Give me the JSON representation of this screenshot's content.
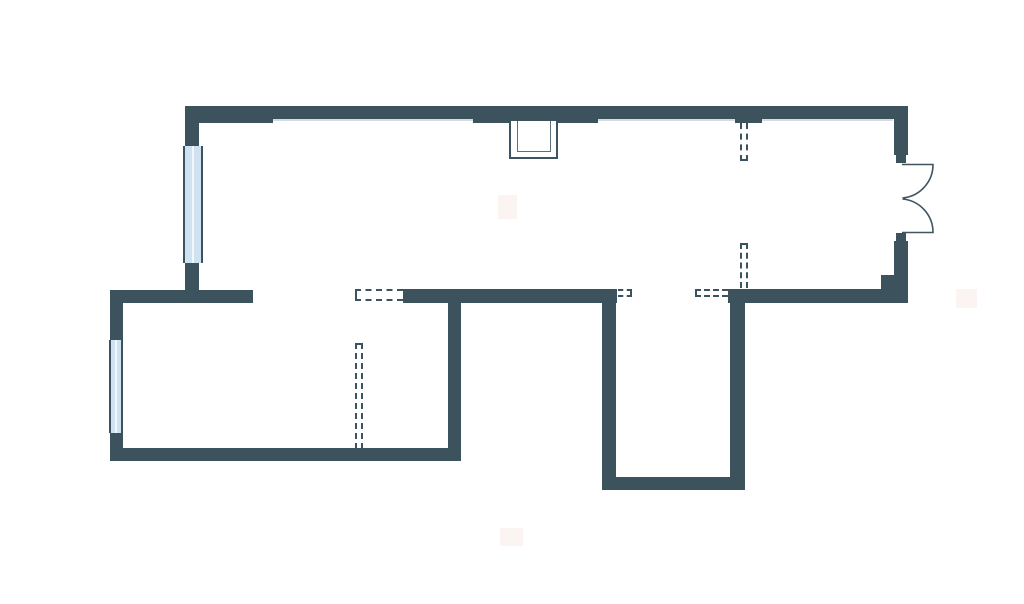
{
  "page": {
    "title": "apartment-floor-plan",
    "description": "2D architectural floor plan with solid walls, two glazed windows, a double-swing entrance door, a ventilation shaft and dashed demolished/optional partition markers. No visible text labels."
  },
  "canvas": {
    "width": 1024,
    "height": 604,
    "background": "#ffffff"
  },
  "colors": {
    "wall": "#3C525C",
    "sill_line": "#D5DDE1",
    "window_glass": "#CFE2F2",
    "window_divider": "#F2F7FB",
    "window_frame": "#3C525C",
    "shaft_outer": "#3E545E",
    "shaft_inner": "#5E707A",
    "door": "#3F555F",
    "dashed": "#3C525C",
    "artifact": "#F9EDE9"
  },
  "plan": {
    "walls": [
      {
        "name": "top-wall-main",
        "x": 185,
        "y": 106,
        "w": 723,
        "h": 13
      },
      {
        "name": "top-wall-thick-left",
        "x": 185,
        "y": 106,
        "w": 88,
        "h": 17
      },
      {
        "name": "top-wall-thick-center",
        "x": 473,
        "y": 106,
        "w": 125,
        "h": 17
      },
      {
        "name": "top-wall-thick-right",
        "x": 735,
        "y": 106,
        "w": 27,
        "h": 17
      },
      {
        "name": "left-upper-wall-above-window",
        "x": 185,
        "y": 106,
        "w": 14,
        "h": 42
      },
      {
        "name": "left-upper-wall-below-window",
        "x": 185,
        "y": 261,
        "w": 14,
        "h": 42
      },
      {
        "name": "middle-wall-left",
        "x": 110,
        "y": 290,
        "w": 143,
        "h": 13
      },
      {
        "name": "middle-wall-center",
        "x": 403,
        "y": 289,
        "w": 214,
        "h": 14
      },
      {
        "name": "middle-wall-right",
        "x": 728,
        "y": 289,
        "w": 180,
        "h": 14
      },
      {
        "name": "left-lower-wall-above-window",
        "x": 110,
        "y": 290,
        "w": 13,
        "h": 51
      },
      {
        "name": "left-lower-wall-below-window",
        "x": 110,
        "y": 432,
        "w": 13,
        "h": 29
      },
      {
        "name": "bottom-wall-lower-room",
        "x": 110,
        "y": 448,
        "w": 351,
        "h": 13
      },
      {
        "name": "lower-room-right-wall",
        "x": 448,
        "y": 302,
        "w": 13,
        "h": 159
      },
      {
        "name": "protrusion-left-wall",
        "x": 602,
        "y": 302,
        "w": 14,
        "h": 178
      },
      {
        "name": "protrusion-bottom-wall",
        "x": 602,
        "y": 477,
        "w": 143,
        "h": 13
      },
      {
        "name": "protrusion-right-wall",
        "x": 730,
        "y": 303,
        "w": 15,
        "h": 187
      },
      {
        "name": "right-wall-above-door",
        "x": 894,
        "y": 106,
        "w": 14,
        "h": 49
      },
      {
        "name": "right-wall-below-door",
        "x": 894,
        "y": 241,
        "w": 14,
        "h": 62
      },
      {
        "name": "right-wall-pier",
        "x": 881,
        "y": 275,
        "w": 27,
        "h": 28
      },
      {
        "name": "door-jamb-top",
        "x": 896,
        "y": 155,
        "w": 10,
        "h": 8
      },
      {
        "name": "door-jamb-bottom",
        "x": 896,
        "y": 233,
        "w": 10,
        "h": 8
      }
    ],
    "sill_lines": [
      {
        "name": "top-wall-sill-line-a",
        "x": 273,
        "y": 119,
        "w": 200,
        "h": 2
      },
      {
        "name": "top-wall-sill-line-b",
        "x": 598,
        "y": 119,
        "w": 137,
        "h": 2
      },
      {
        "name": "top-wall-sill-line-c",
        "x": 762,
        "y": 119,
        "w": 131,
        "h": 2
      }
    ],
    "windows": [
      {
        "name": "window-upper-left",
        "x": 183,
        "y": 146,
        "w": 20,
        "h": 117
      },
      {
        "name": "window-lower-left",
        "x": 109,
        "y": 340,
        "w": 14,
        "h": 93
      }
    ],
    "dashed_openings": [
      {
        "name": "dashed-partition-right-top",
        "x": 740,
        "y": 123,
        "w": 8,
        "h": 38,
        "sides": [
          "left",
          "right",
          "bottom"
        ]
      },
      {
        "name": "dashed-partition-right-middle",
        "x": 740,
        "y": 243,
        "w": 8,
        "h": 45,
        "sides": [
          "left",
          "right",
          "top"
        ]
      },
      {
        "name": "dashed-opening-middle-wall",
        "x": 355,
        "y": 289,
        "w": 48,
        "h": 12,
        "sides": [
          "top",
          "left",
          "bottom"
        ]
      },
      {
        "name": "dashed-partition-lower-room",
        "x": 355,
        "y": 343,
        "w": 8,
        "h": 106,
        "sides": [
          "left",
          "right",
          "top"
        ]
      },
      {
        "name": "dashed-opening-jamb-left",
        "x": 618,
        "y": 289,
        "w": 14,
        "h": 8,
        "sides": [
          "top",
          "right",
          "bottom"
        ]
      },
      {
        "name": "dashed-opening-jamb-right",
        "x": 695,
        "y": 289,
        "w": 33,
        "h": 8,
        "sides": [
          "top",
          "left",
          "bottom"
        ]
      }
    ],
    "shaft_boxes": [
      {
        "name": "vent-shaft-outer",
        "x": 509,
        "y": 121,
        "w": 49,
        "h": 38,
        "stroke": 2,
        "color_key": "shaft_outer"
      },
      {
        "name": "vent-shaft-inner",
        "x": 517,
        "y": 121,
        "w": 34,
        "h": 31,
        "stroke": 1.5,
        "color_key": "shaft_inner"
      }
    ],
    "door": {
      "name": "entrance-double-door",
      "stroke_width": 1.6,
      "leaves": [
        "M 902 164.5 H 933 A 33.5 33.5 0 0 1 902.5 198",
        "M 902 232.5 H 933 A 33.5 33.5 0 0 0 902.5 199"
      ]
    },
    "artifacts": [
      {
        "name": "faint-mark-top-center",
        "x": 498,
        "y": 195,
        "w": 19,
        "h": 24
      },
      {
        "name": "faint-mark-right-middle",
        "x": 956,
        "y": 289,
        "w": 21,
        "h": 19
      },
      {
        "name": "faint-mark-bottom-center",
        "x": 500,
        "y": 528,
        "w": 23,
        "h": 18
      }
    ]
  }
}
